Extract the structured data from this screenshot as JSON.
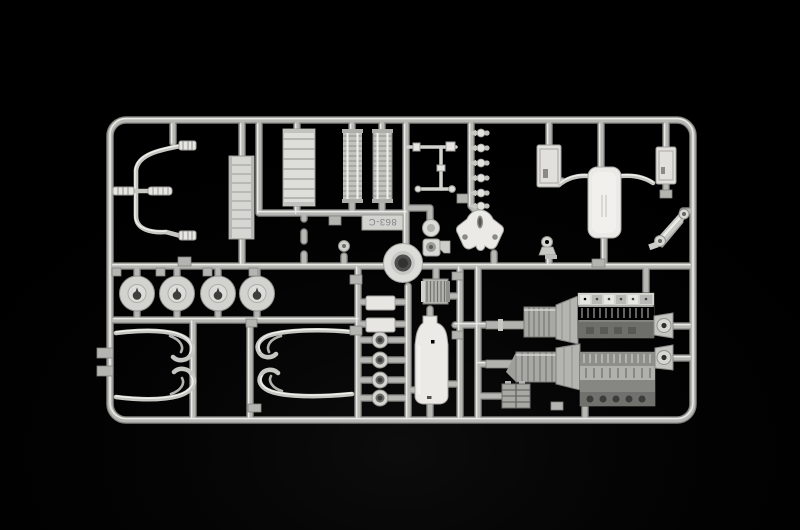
{
  "sprue": {
    "mold_label": "863-C",
    "label_orientation": "upside-down",
    "background_color": "#000000",
    "plastic_color": "#cdcdc9",
    "plastic_highlight": "#efefeb",
    "plastic_shadow": "#6f6f6d",
    "frame_shape": "rounded-rectangle runner frame",
    "part_names": [
      "bent-tube-assembly",
      "ribbed-coupler",
      "radiator-core",
      "ribbed-panel",
      "filter-cartridge-left",
      "filter-cartridge-right",
      "mold-number-tag",
      "steering-linkage-rods",
      "injector-set",
      "engine-mount-bracket",
      "steering-box",
      "radiator-shell-left",
      "exhaust-muffler-tank",
      "radiator-shell-right",
      "suspension-link-arm",
      "exhaust-elbow",
      "small-pulley",
      "wheel-hub-disc-1",
      "wheel-hub-disc-2",
      "wheel-hub-disc-3",
      "wheel-hub-disc-4",
      "exhaust-pipe-group-left",
      "exhaust-pipe-group-right",
      "center-ring",
      "mounting-plate-upper",
      "mounting-plate-lower",
      "grommet-rings",
      "oil-cooler",
      "fuel-tank-bottle",
      "engine-block-top",
      "gearbox-top",
      "engine-block-bottom",
      "gearbox-bottom",
      "battery-box"
    ]
  }
}
